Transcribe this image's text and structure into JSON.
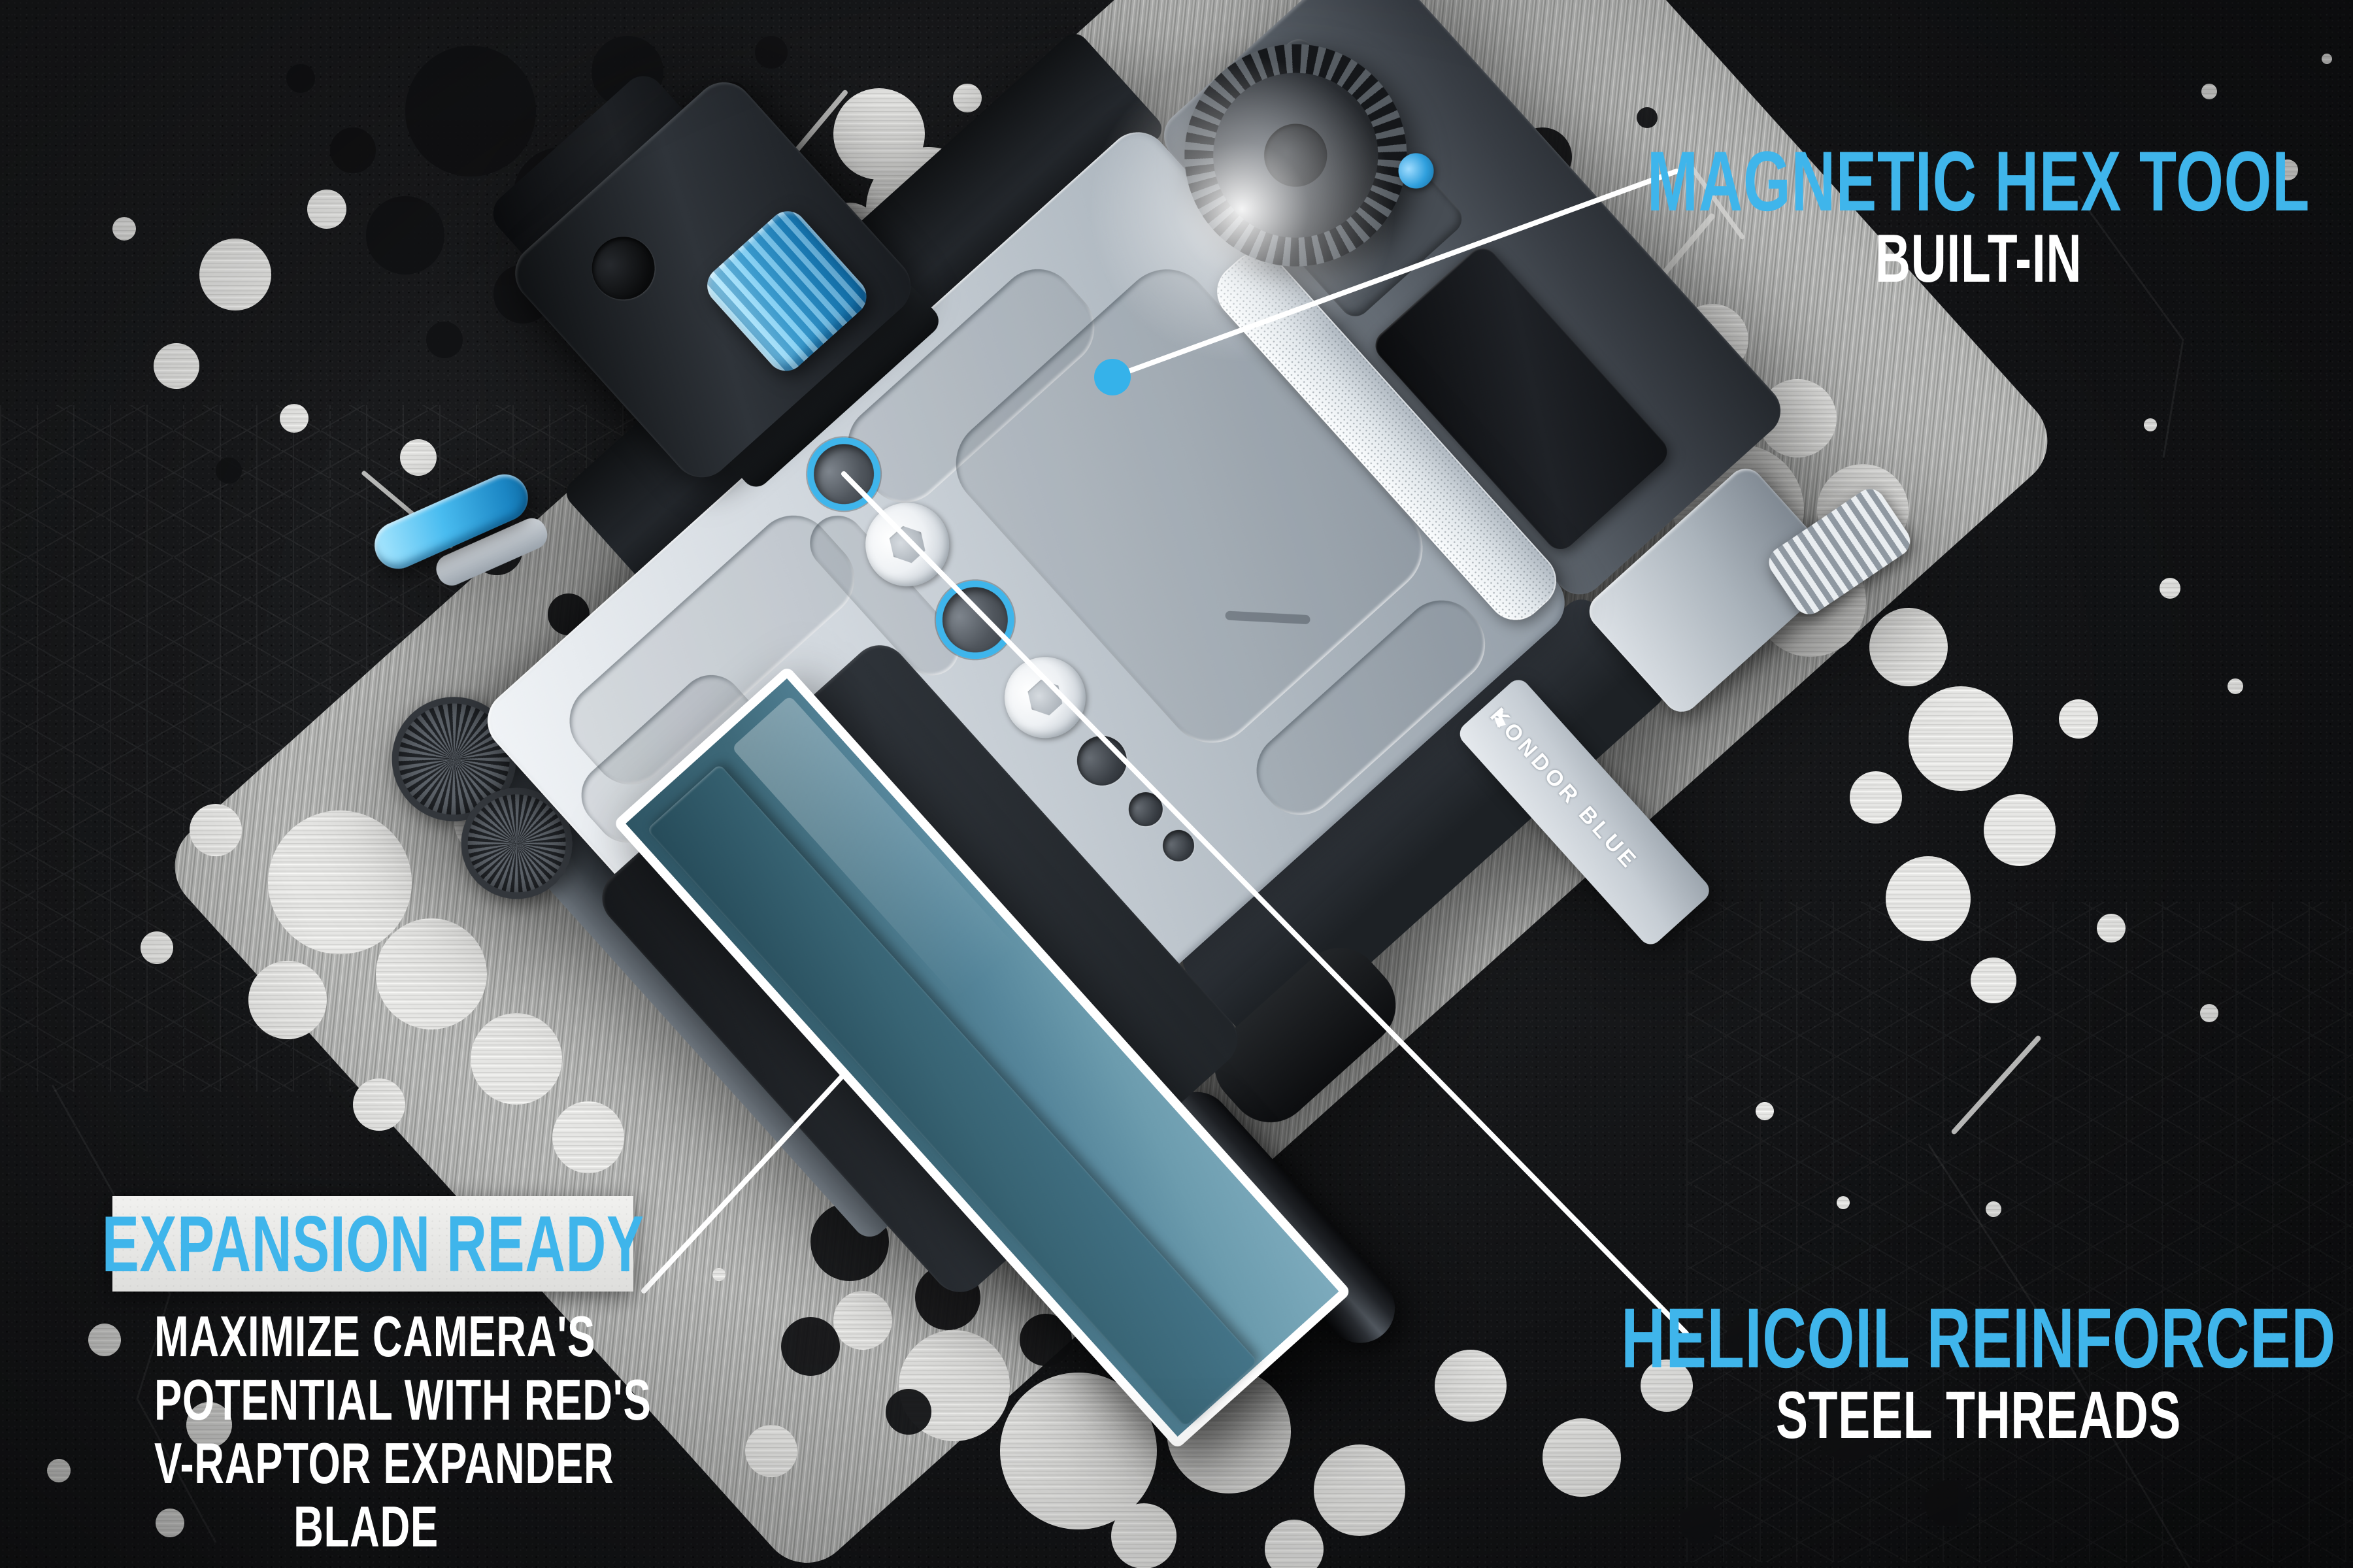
{
  "callouts": {
    "magnetic_hex": {
      "title": "MAGNETIC HEX TOOL",
      "subtitle": "BUILT-IN"
    },
    "expansion": {
      "title": "EXPANSION READY",
      "body_lines": [
        "MAXIMIZE CAMERA'S",
        "POTENTIAL WITH RED'S",
        "V-RAPTOR EXPANDER",
        "BLADE"
      ]
    },
    "helicoil": {
      "title": "HELICOIL REINFORCED",
      "subtitle": "STEEL THREADS"
    }
  },
  "product": {
    "brand": "KONDOR BLUE"
  },
  "colors": {
    "accent_cyan": "#3FB5EB",
    "callout_line_white": "#FFFFFF",
    "expansion_box_bg": "#E9E9E7",
    "blade_teal": "#4E7D8E",
    "anodized_blue": "#2E9FD8",
    "plate_silver": "#C7CED5",
    "background_slate": "#17181A"
  }
}
